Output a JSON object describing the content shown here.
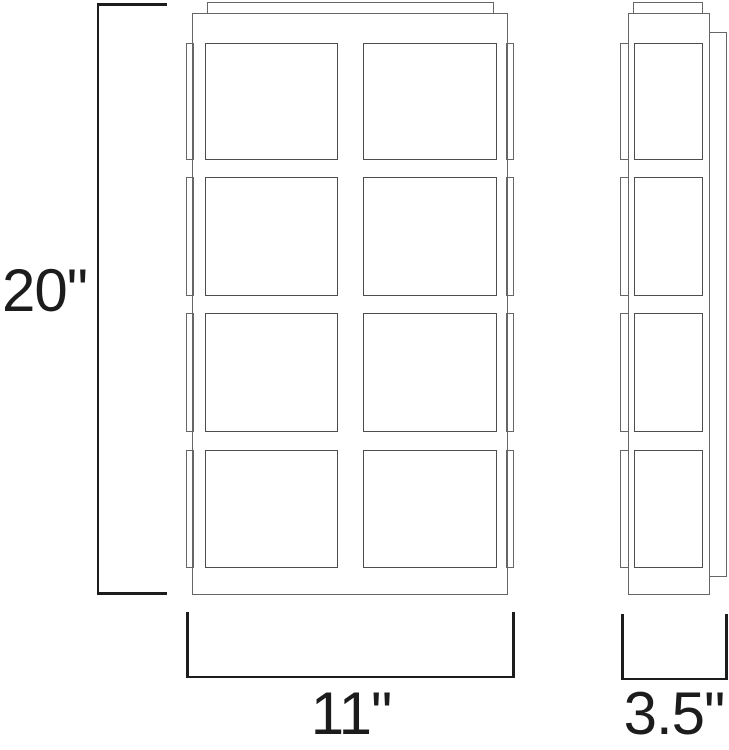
{
  "diagram": {
    "name": "wall-sconce-dimension-drawing",
    "dimensions": {
      "height": {
        "label": "20\"",
        "value_inches": 20,
        "axis": "vertical"
      },
      "width": {
        "label": "11\"",
        "value_inches": 11,
        "axis": "horizontal"
      },
      "depth": {
        "label": "3.5\"",
        "value_inches": 3.5,
        "axis": "horizontal"
      }
    },
    "views": {
      "front": {
        "name": "front-view",
        "pane_rows": 4,
        "pane_cols": 2,
        "side_tabs_per_side": 4
      },
      "side": {
        "name": "side-view",
        "pane_rows": 4,
        "pane_cols": 1,
        "tabs": 4,
        "has_back_plate": true
      }
    },
    "colors": {
      "background": "#ffffff",
      "fixture_outline": "#666666",
      "pane_outline": "#4d4d4d",
      "dimension": "#1c1c1c"
    }
  }
}
